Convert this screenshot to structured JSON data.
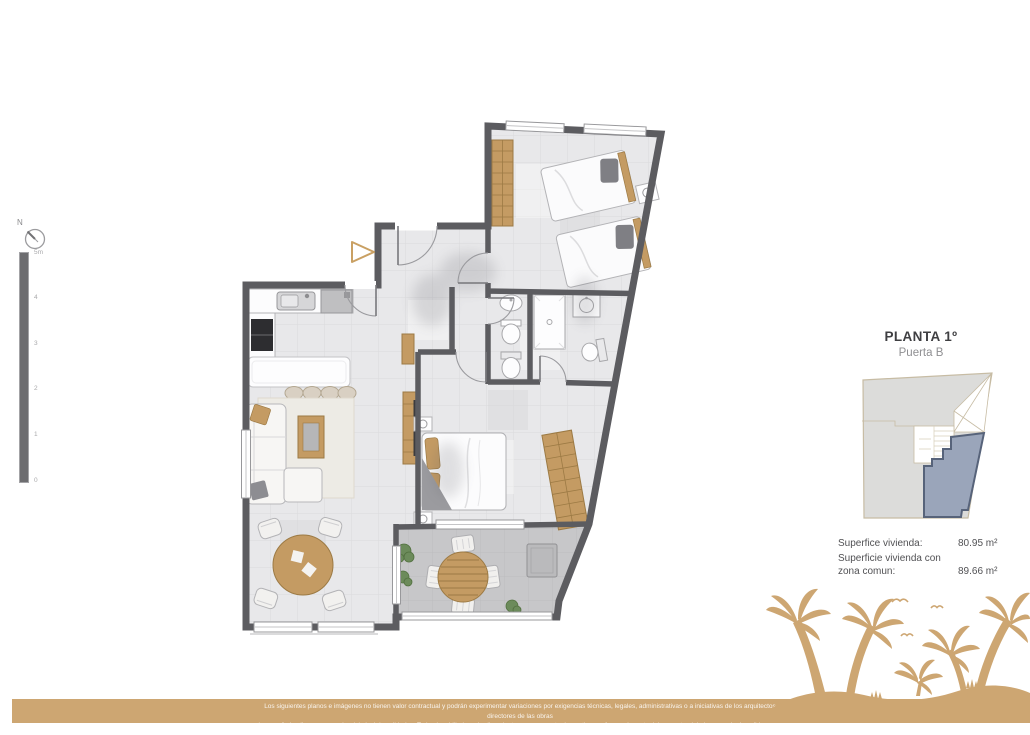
{
  "compass": {
    "label": "N"
  },
  "scalebar": {
    "labels": [
      "5m",
      "4",
      "3",
      "2",
      "1",
      "0"
    ]
  },
  "panel": {
    "title": "PLANTA 1º",
    "subtitle": "Puerta B",
    "areas": [
      {
        "label": "Superfice vivienda:",
        "value": "80.95 m²"
      },
      {
        "label": "Superficie vivienda con zona comun:",
        "value": "89.66 m²"
      }
    ]
  },
  "footer": {
    "disclaimer_line1": "Los siguientes planos e imágenes no tienen valor contractual y podrán experimentar variaciones por exigencias técnicas, legales, administrativas o a iniciativas de los arquitectos directores de las obras",
    "disclaimer_line2": "sin que ello implique menoscabo del nivel de calidades. Todo el mobiliario y ajardinamiento es meramente decorativo, no formando parte del proyecto ni de la memoria de calidades del proyecto."
  },
  "colors": {
    "accent_gold": "#cda672",
    "wall_gray": "#5c5c60",
    "wood": "#c49b63",
    "unit_highlight": "#9aa5ba",
    "unit_border": "#57637a"
  }
}
